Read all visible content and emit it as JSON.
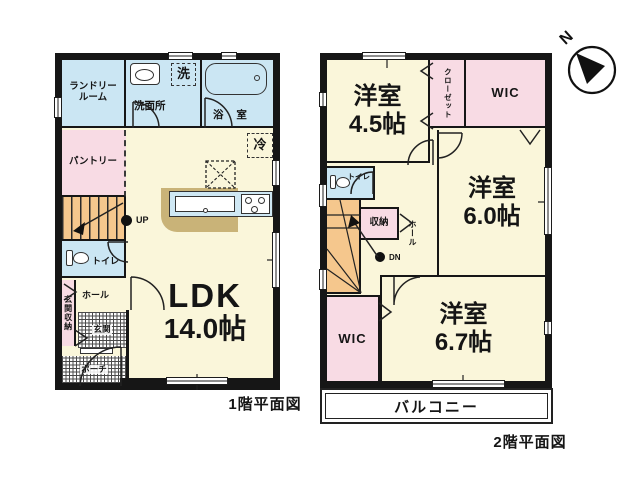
{
  "compass": {
    "n": "N"
  },
  "floor1": {
    "caption": "1階平面図",
    "laundry_line1": "ランドリー",
    "laundry_line2": "ルーム",
    "washer": "洗",
    "washroom": "洗面所",
    "bath": "浴 室",
    "pantry": "パントリー",
    "fridge": "冷",
    "up": "UP",
    "toilet": "トイレ",
    "hall": "ホール",
    "entrance_storage": "玄関収納",
    "entrance": "玄関",
    "porch": "ポーチ",
    "ldk_line1": "LDK",
    "ldk_line2": "14.0帖"
  },
  "floor2": {
    "caption": "2階平面図",
    "room45_line1": "洋室",
    "room45_line2": "4.5帖",
    "closet": "クローゼット",
    "wic_top": "WIC",
    "room60_line1": "洋室",
    "room60_line2": "6.0帖",
    "toilet": "トイレ",
    "storage": "収納",
    "hall": "ホール",
    "dn": "DN",
    "wic_bottom": "WIC",
    "room67_line1": "洋室",
    "room67_line2": "6.7帖",
    "balcony": "バルコニー"
  },
  "colors": {
    "wall": "#161616",
    "room_cream": "#faf6da",
    "wet_blue": "#cbe6f3",
    "closet_pink": "#f8dbe4",
    "stairs_orange": "#f5c78d",
    "counter_tan": "#c9b378"
  }
}
